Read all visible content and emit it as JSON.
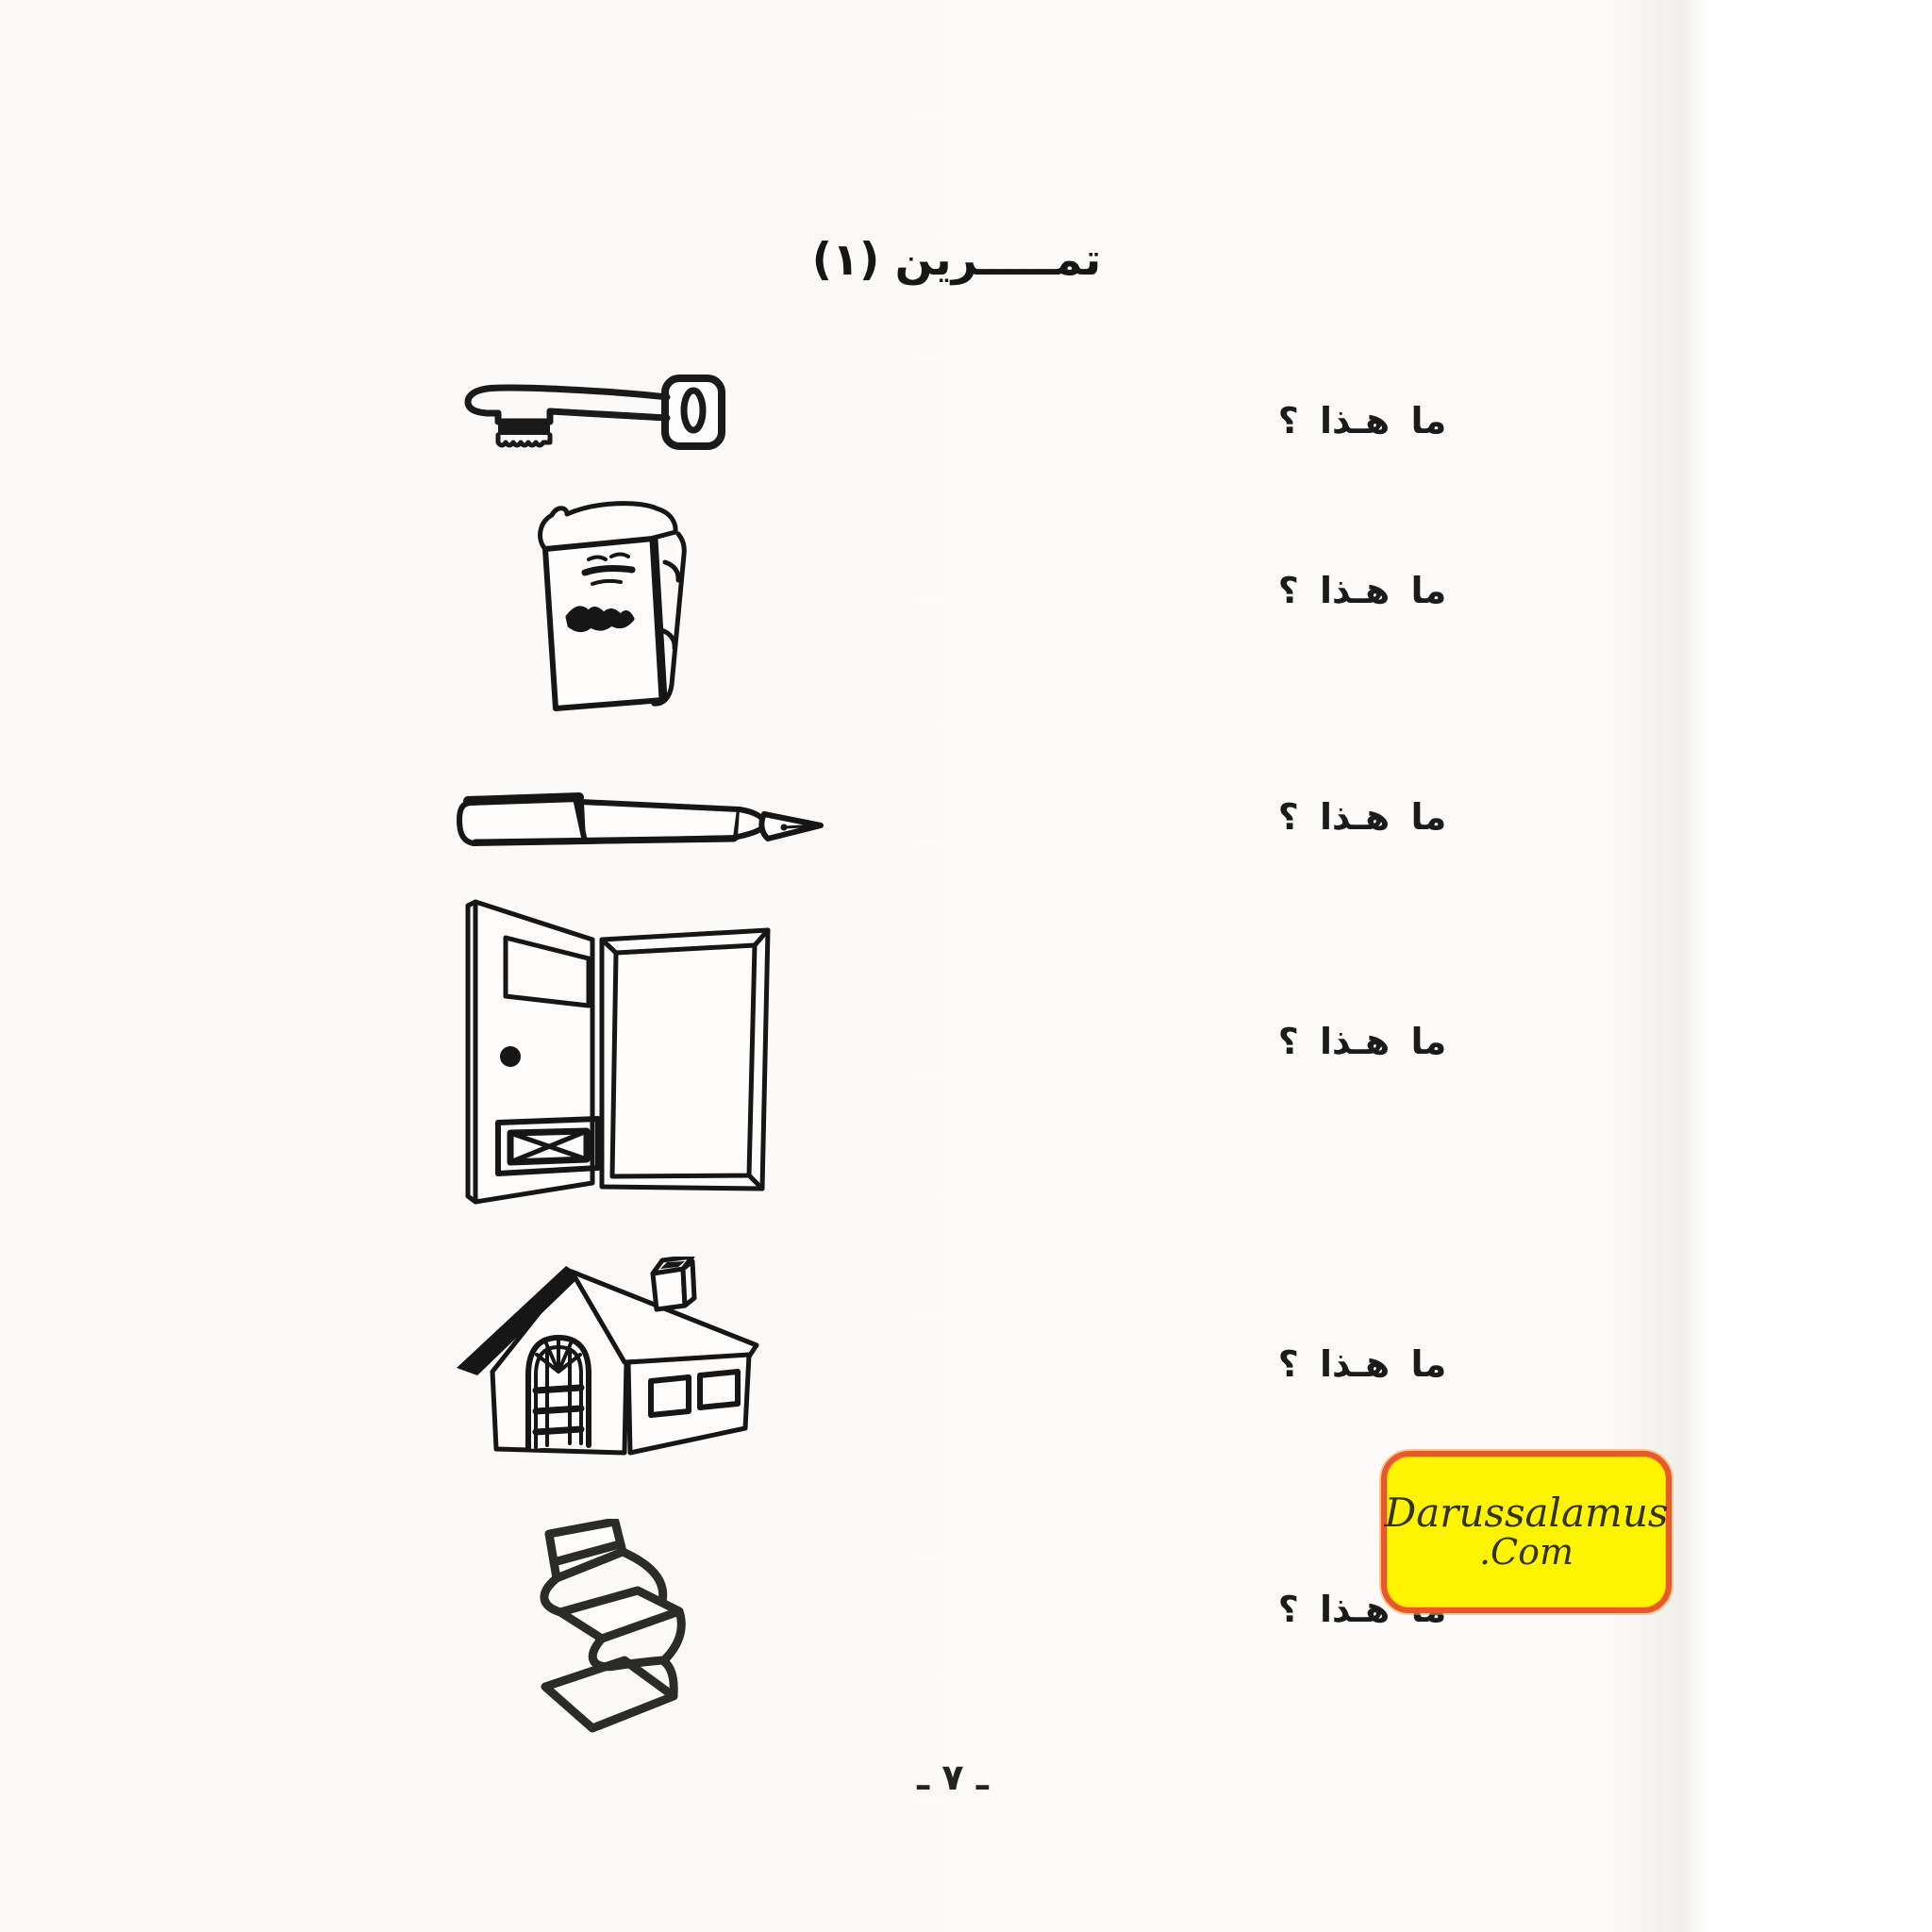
{
  "header": {
    "title": "تمـــــرين (١)"
  },
  "exercise": {
    "items": [
      {
        "illustration": "key",
        "prompt": "ما هـذا ؟"
      },
      {
        "illustration": "book",
        "prompt": "ما هـذا ؟"
      },
      {
        "illustration": "fountain-pen",
        "prompt": "ما هـذا ؟"
      },
      {
        "illustration": "open-door",
        "prompt": "ما هـذا ؟"
      },
      {
        "illustration": "house",
        "prompt": "ما هـذا ؟"
      },
      {
        "illustration": "chair",
        "prompt": "ما هـذا ؟"
      }
    ]
  },
  "watermark": {
    "line1": "Darussalamus",
    "line2": ".Com",
    "background": "#FFF400",
    "border_color": "#E8582A",
    "text_color": "#33330F"
  },
  "footer": {
    "page_number": "ـ ٧ ـ"
  },
  "colors": {
    "ink": "#1B1B1B",
    "paper": "#FCFBF8"
  }
}
